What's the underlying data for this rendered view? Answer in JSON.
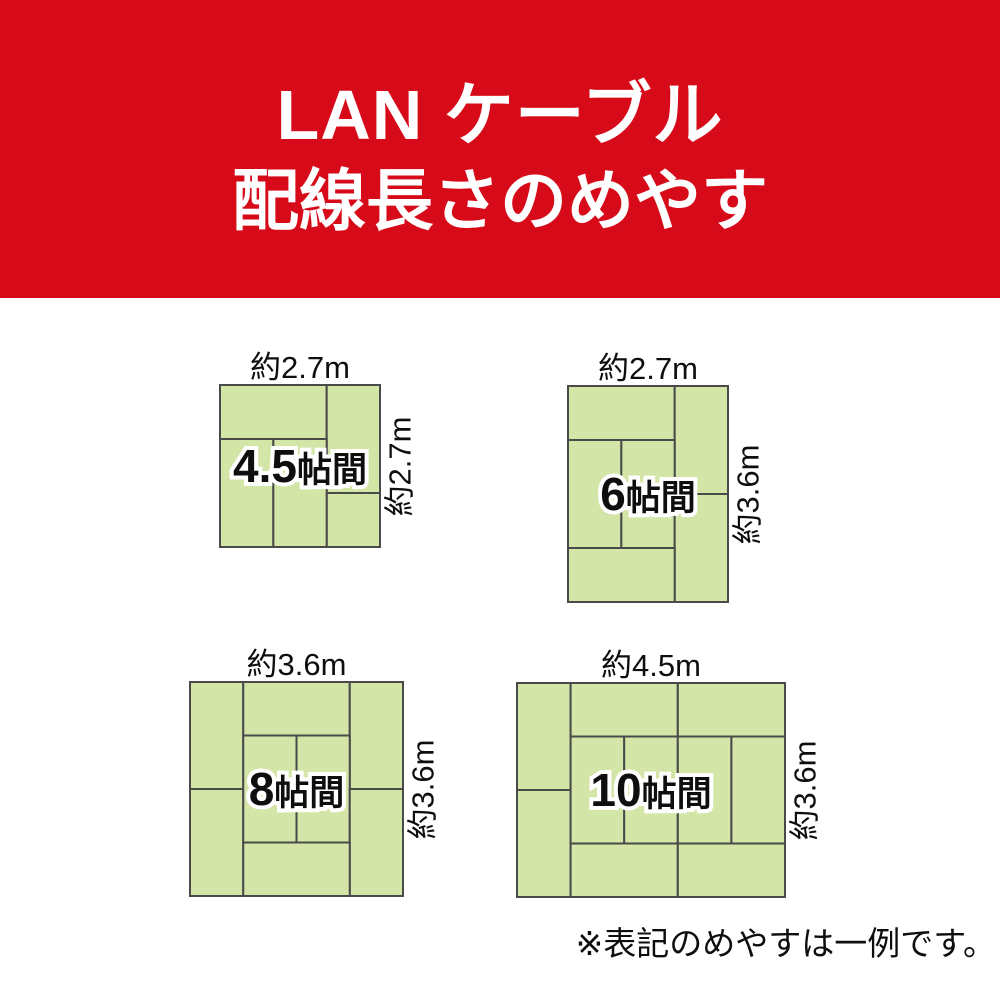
{
  "header": {
    "title_line1": "LAN ケーブル",
    "title_line2": "配線長さのめやす",
    "bg_color": "#d70a19",
    "text_color": "#ffffff"
  },
  "colors": {
    "tatami_fill": "#d3e5a7",
    "tatami_stroke": "#4a4a4a",
    "label_text": "#0e0e0e",
    "label_outline": "#ffffff"
  },
  "note": {
    "text": "※表記のめやすは一例です。"
  },
  "rooms": [
    {
      "id": "4-5jo",
      "label_num": "4.5",
      "label_suffix": "帖間",
      "width_label": "約2.7m",
      "height_label": "約2.7m",
      "rect": {
        "x": 220,
        "y": 385,
        "w": 160,
        "h": 162
      },
      "grid": {
        "cols": 3,
        "rows": 3
      },
      "mats": [
        [
          0,
          0,
          2,
          1
        ],
        [
          2,
          0,
          1,
          2
        ],
        [
          2,
          2,
          1,
          1
        ],
        [
          0,
          1,
          1,
          2
        ],
        [
          1,
          1,
          1,
          2
        ]
      ]
    },
    {
      "id": "6jo",
      "label_num": "6",
      "label_suffix": "帖間",
      "width_label": "約2.7m",
      "height_label": "約3.6m",
      "rect": {
        "x": 568,
        "y": 386,
        "w": 160,
        "h": 216
      },
      "grid": {
        "cols": 3,
        "rows": 4
      },
      "mats": [
        [
          0,
          0,
          2,
          1
        ],
        [
          2,
          0,
          1,
          2
        ],
        [
          0,
          1,
          1,
          2
        ],
        [
          1,
          1,
          1,
          2
        ],
        [
          2,
          2,
          1,
          2
        ],
        [
          0,
          3,
          2,
          1
        ]
      ]
    },
    {
      "id": "8jo",
      "label_num": "8",
      "label_suffix": "帖間",
      "width_label": "約3.6m",
      "height_label": "約3.6m",
      "rect": {
        "x": 190,
        "y": 682,
        "w": 213,
        "h": 214
      },
      "grid": {
        "cols": 4,
        "rows": 4
      },
      "mats": [
        [
          0,
          0,
          1,
          2
        ],
        [
          1,
          0,
          2,
          1
        ],
        [
          3,
          0,
          1,
          2
        ],
        [
          0,
          2,
          1,
          2
        ],
        [
          1,
          1,
          1,
          2
        ],
        [
          2,
          1,
          1,
          2
        ],
        [
          3,
          2,
          1,
          2
        ],
        [
          1,
          3,
          2,
          1
        ]
      ]
    },
    {
      "id": "10jo",
      "label_num": "10",
      "label_suffix": "帖間",
      "width_label": "約4.5m",
      "height_label": "約3.6m",
      "rect": {
        "x": 517,
        "y": 683,
        "w": 268,
        "h": 214
      },
      "grid": {
        "cols": 5,
        "rows": 4
      },
      "mats": [
        [
          0,
          0,
          1,
          2
        ],
        [
          1,
          0,
          2,
          1
        ],
        [
          3,
          0,
          2,
          1
        ],
        [
          0,
          2,
          1,
          2
        ],
        [
          1,
          1,
          1,
          2
        ],
        [
          2,
          1,
          1,
          2
        ],
        [
          3,
          1,
          1,
          2
        ],
        [
          4,
          1,
          1,
          2
        ],
        [
          1,
          3,
          2,
          1
        ],
        [
          3,
          3,
          2,
          1
        ]
      ]
    }
  ]
}
